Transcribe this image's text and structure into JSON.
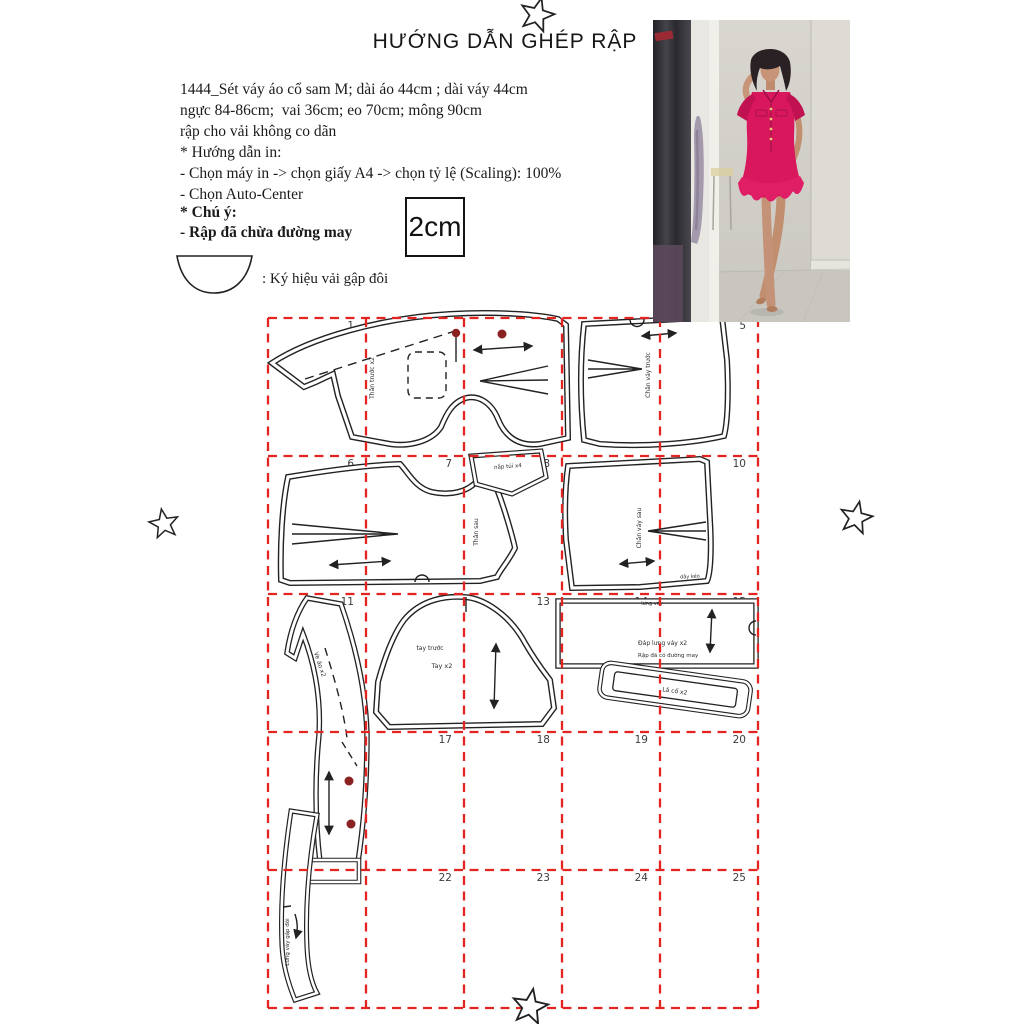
{
  "title": "HƯỚNG DẪN GHÉP RẬP",
  "info": {
    "line1": "1444_Sét váy áo cổ sam M; dài áo 44cm ; dài váy 44cm",
    "line2": "ngực 84-86cm;  vai 36cm; eo 70cm; mông 90cm",
    "line3": "rập cho vải không co dãn",
    "print_header": "* Hướng dẫn in:",
    "print_step1": "- Chọn máy in -> chọn giấy A4 -> chọn tỷ lệ (Scaling): 100%",
    "print_step2": "- Chọn Auto-Center"
  },
  "note": {
    "header": "* Chú ý:",
    "line": "- Rập đã chừa đường may"
  },
  "scale_label": "2cm",
  "fold_symbol_label": ": Ký hiệu vải gập đôi",
  "grid": {
    "page_numbers": [
      "1",
      "2",
      "3",
      "4",
      "5",
      "6",
      "7",
      "8",
      "9",
      "10",
      "11",
      "12",
      "13",
      "14",
      "15",
      "16",
      "17",
      "18",
      "19",
      "20",
      "21",
      "22",
      "23",
      "24",
      "25"
    ]
  },
  "pieces": {
    "front_bodice_label": "Thân trước x2",
    "front_skirt_label": "Chân váy trước",
    "back_bodice_label": "Thân sau",
    "pocket_flap_label": "nắp túi x4",
    "back_skirt_label": "Chân váy sau",
    "back_skirt_note": "dây kéo",
    "lapel_label": "Ve áo x2",
    "sleeve_note": "tay trước",
    "sleeve_label": "Tay x2",
    "waist_facing_note": "lưng váy",
    "waist_facing_label": "Đáp lưng váy x2",
    "waist_facing_note2": "Rập đã có đường may",
    "collar_label": "Lá cổ x2",
    "waistband_label": "Lưng váy gập đôi"
  },
  "colors": {
    "grid_red": "#e32420",
    "outline": "#222222",
    "button_dot": "#8b2222",
    "dress_pink": "#d8175d"
  }
}
